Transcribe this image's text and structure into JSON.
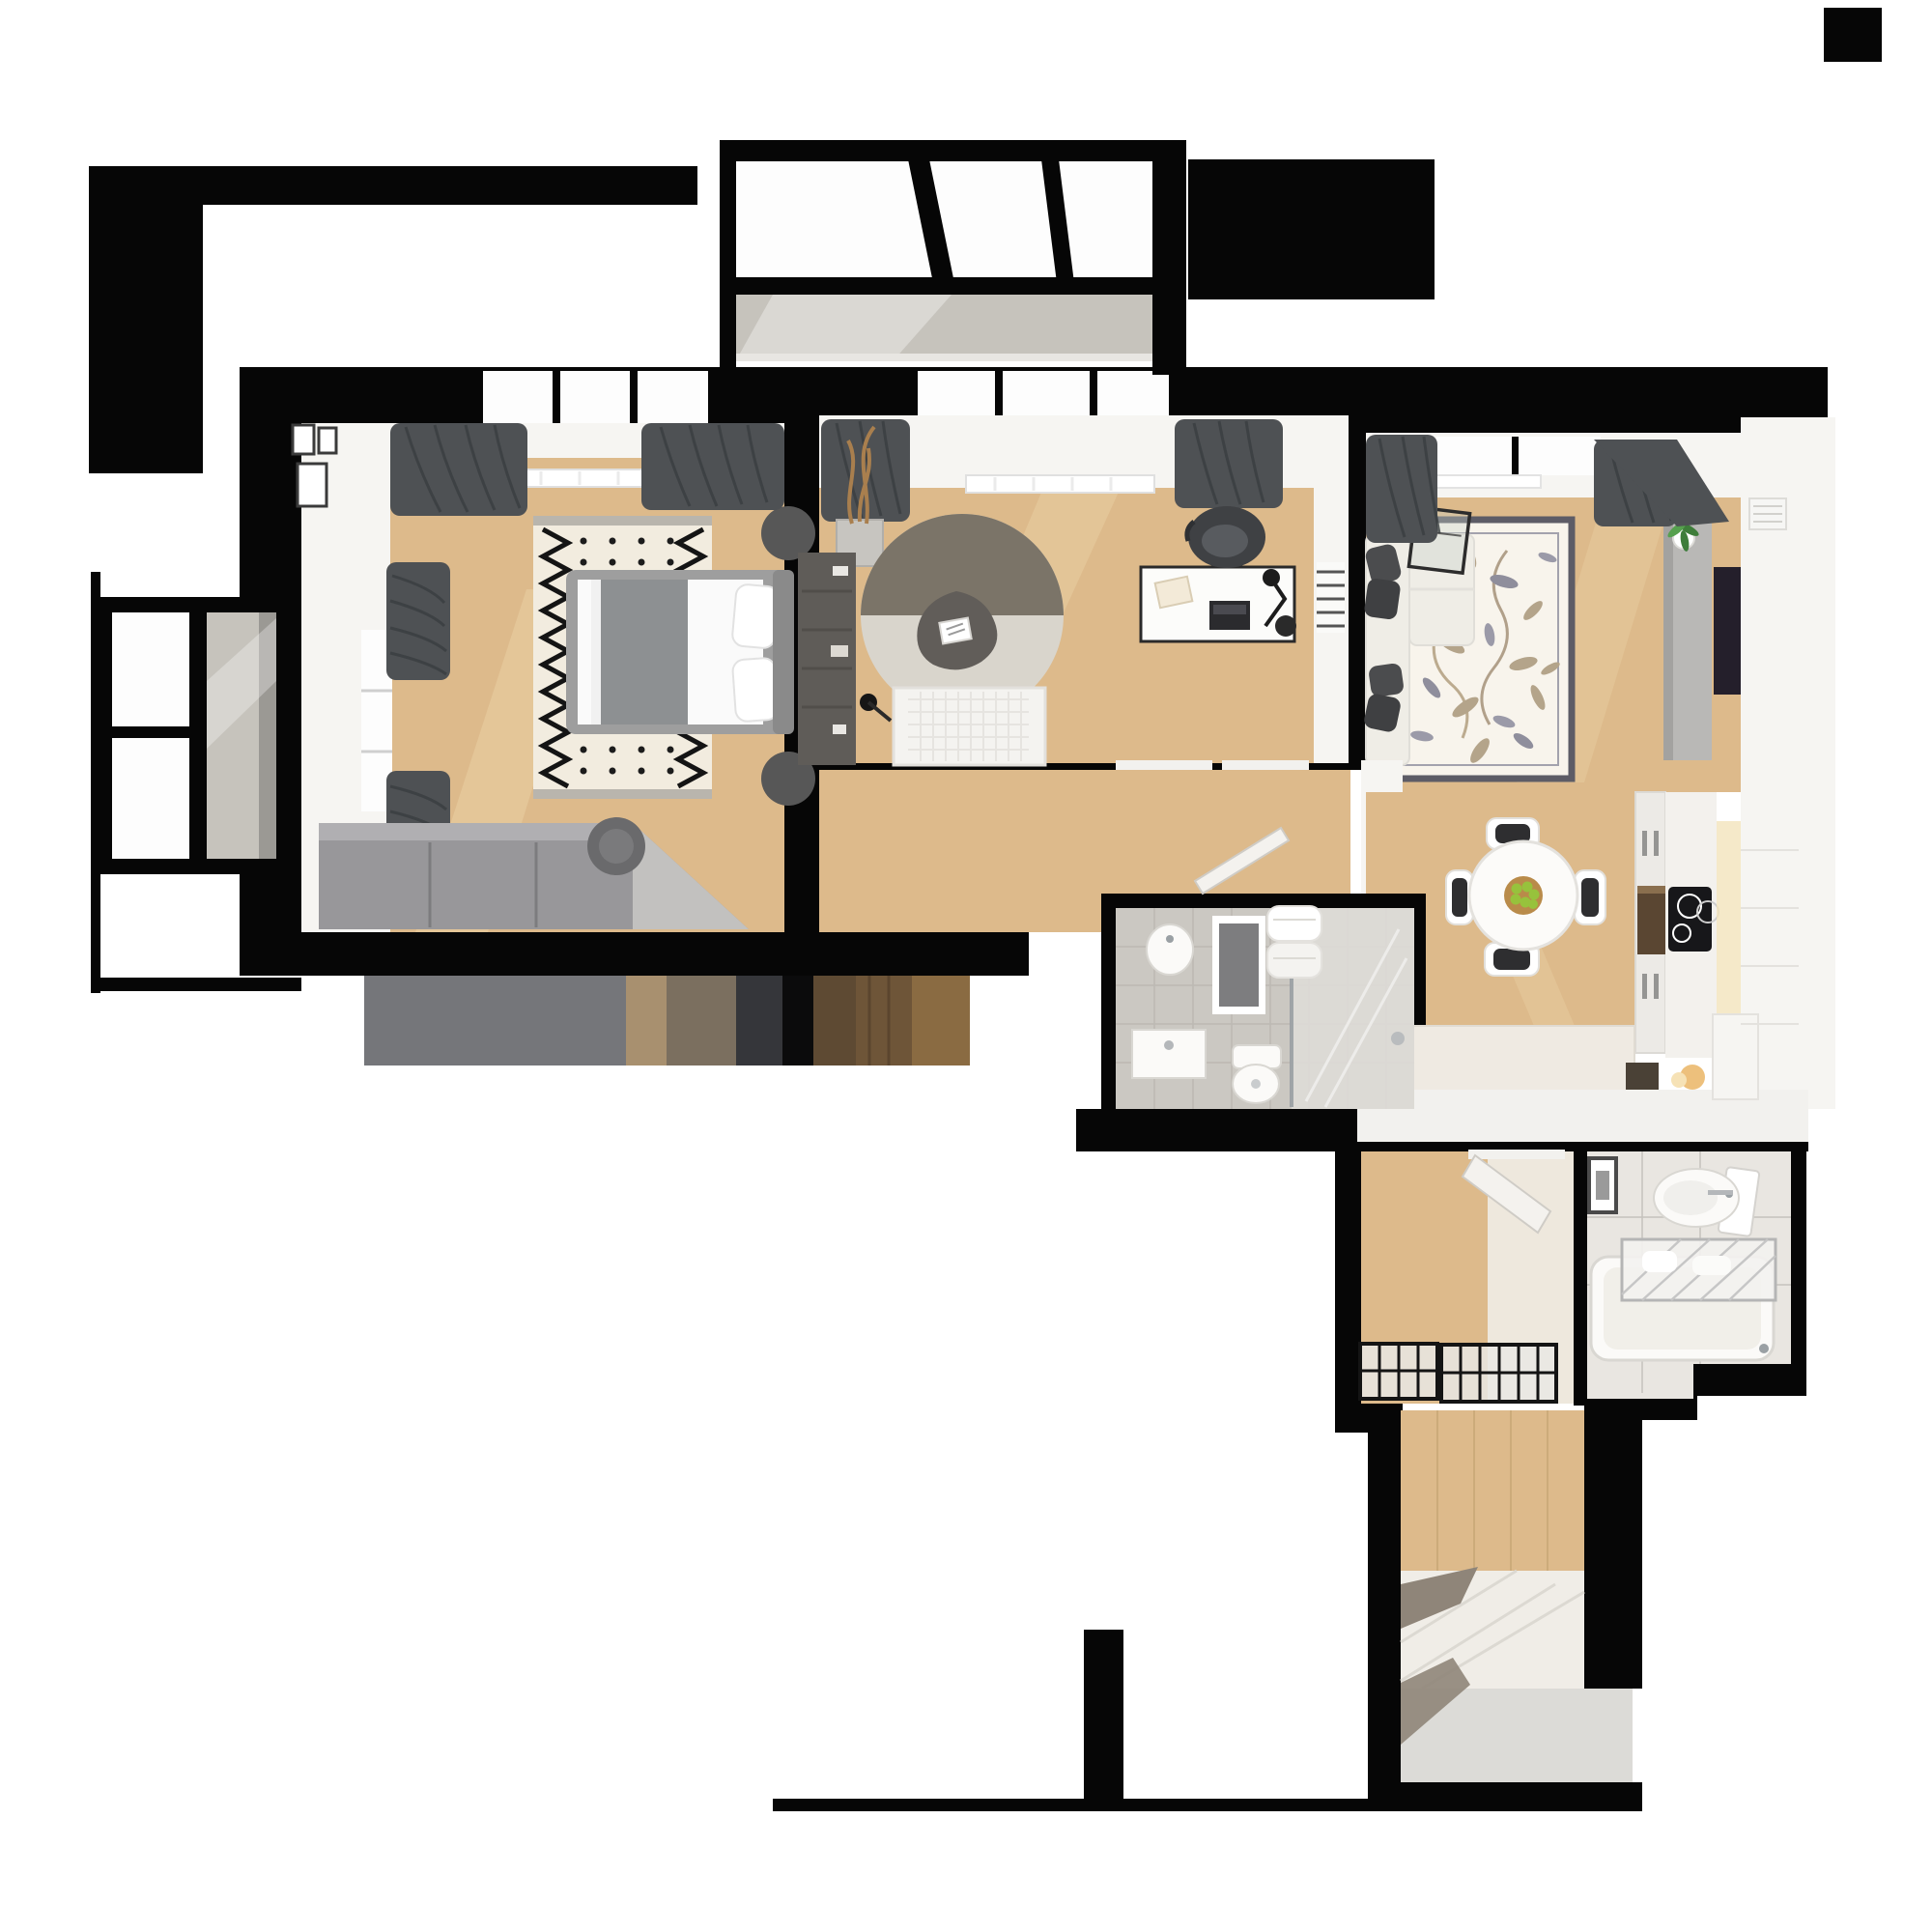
{
  "title": "Top-down 3D render of a furnished apartment floor plan",
  "background": "#ffffff",
  "palette": {
    "bg": "#ffffff",
    "wall": "#060606",
    "wood": "#ddba8b",
    "wood_light": "#ecd2a6",
    "white_surface": "#f6f5f2",
    "glass": "#fdfdfd",
    "tile": "#c6c3bc",
    "bath_tile": "#cbc8c2",
    "grout": "#b7b4ae",
    "fixture": "#fbfaf8",
    "fixture_edge": "#d9d7d2",
    "curtain": "#4e5154",
    "curtain_fold": "#3a3d40",
    "rug_cream": "#f2ecdf",
    "rug_fringe": "#b9b5ad",
    "rug_floral": "#f8f4ec",
    "rug_border": "#5d5c66",
    "round_rug_dark": "#7b7468",
    "round_rug_light": "#d9d5cc",
    "tri_table": "#615d59",
    "sofa": "#efede6",
    "pillow": "#4b4c4e",
    "tv": "#241f2b",
    "tv_cabinet": "#b9b8b6",
    "wardrobe": "#98979a",
    "wardrobe_top": "#b0afb2",
    "wardrobe_angle": "#c2c1bf",
    "bed_frame": "#9e9e9e",
    "blanket": "#8d9092",
    "dark_cabinet": "#5f5c58",
    "chair_dark": "#3f4144",
    "apple": "#97c23c",
    "bowl": "#b98b4a",
    "hob": "#17171a",
    "oven": "#5a4632",
    "glow": "#f3e3bb",
    "entry_wedge": "#8f8579",
    "stub_floor": "#dcdbd7",
    "stripe_1": "#75767a",
    "stripe_2": "#a8906f",
    "stripe_3": "#7b6f5f",
    "stripe_4": "#35363a",
    "stripe_5": "#0b0b0c",
    "stripe_6": "#5e4a33",
    "stripe_7": "#6e5538",
    "stripe_8": "#8a6b42"
  },
  "rooms": [
    {
      "id": "bedroom",
      "furniture": [
        "double-bed",
        "zigzag-rug",
        "corner-wardrobe",
        "round-nightstands",
        "stool",
        "wall-frames",
        "window-curtains",
        "radiator"
      ]
    },
    {
      "id": "study",
      "furniture": [
        "round-two-tone-rug",
        "triangle-coffee-table",
        "quilted-daybed",
        "desk",
        "office-chair",
        "laptop",
        "desk-lamp",
        "tall-dark-cabinet",
        "driftwood-planter",
        "floor-lamp",
        "curtains",
        "radiator",
        "wall-ladder-radiator"
      ]
    },
    {
      "id": "living-room",
      "furniture": [
        "corner-sofa",
        "dark-pillows",
        "floral-rug",
        "glass-coffee-table",
        "tv-sideboard",
        "potted-plant",
        "tv",
        "wall-shelf",
        "curtains",
        "window-radiator"
      ]
    },
    {
      "id": "kitchen-dining",
      "furniture": [
        "round-dining-table",
        "fruit-bowl-with-apples",
        "four-chairs",
        "tall-cabinet-column",
        "built-in-oven",
        "induction-hob",
        "counter-run",
        "dark-sink-inset",
        "warm-light"
      ]
    },
    {
      "id": "bathroom-shower",
      "furniture": [
        "walk-in-shower",
        "glass-screen",
        "toilet",
        "wall-sink",
        "vanity-cabinet",
        "bath-mat",
        "hanging-towels"
      ]
    },
    {
      "id": "bathroom-tub",
      "furniture": [
        "bathtub",
        "drying-rack-with-laundry",
        "oval-sink",
        "mirror",
        "framed-picture"
      ]
    },
    {
      "id": "hallway",
      "furniture": [
        "two-black-shoe-racks",
        "open-white-door"
      ]
    },
    {
      "id": "entry",
      "furniture": [
        "wood-wall-panel",
        "sliding-wardrobe-reflections",
        "white-tile-floor"
      ]
    },
    {
      "id": "balcony-top",
      "furniture": [
        "black-frame-glazing",
        "tiled-floor"
      ]
    },
    {
      "id": "balcony-left",
      "furniture": [
        "black-frame-glazing",
        "tiled-floor"
      ]
    }
  ]
}
